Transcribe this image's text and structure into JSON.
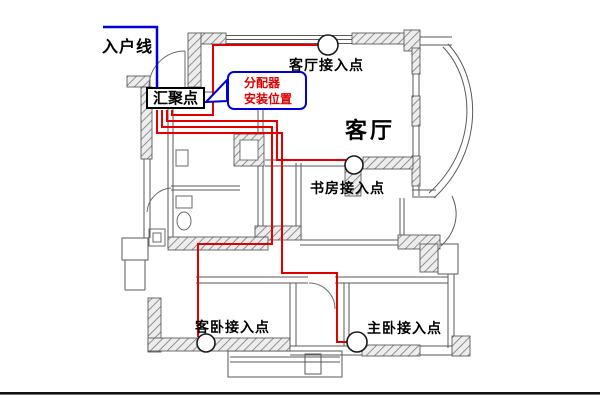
{
  "title": "家庭网络布线平面图",
  "labels": {
    "incoming_line": "入户线",
    "convergence_point": "汇聚点",
    "splitter_line1": "分配器",
    "splitter_line2": "安装位置",
    "living_room_ap": "客厅接入点",
    "living_room": "客厅",
    "study_ap": "书房接入点",
    "guest_bedroom_ap": "客卧接入点",
    "master_bedroom_ap": "主卧接入点"
  },
  "access_points": [
    {
      "name": "living-room-access-point",
      "label": "客厅接入点"
    },
    {
      "name": "study-access-point",
      "label": "书房接入点"
    },
    {
      "name": "guest-bedroom-access-point",
      "label": "客卧接入点"
    },
    {
      "name": "master-bedroom-access-point",
      "label": "主卧接入点"
    }
  ],
  "colors": {
    "cable": "#e00000",
    "incoming": "#0000dd",
    "callout_text": "#e00000",
    "wall": "#5a5a5a",
    "text": "#000000"
  }
}
